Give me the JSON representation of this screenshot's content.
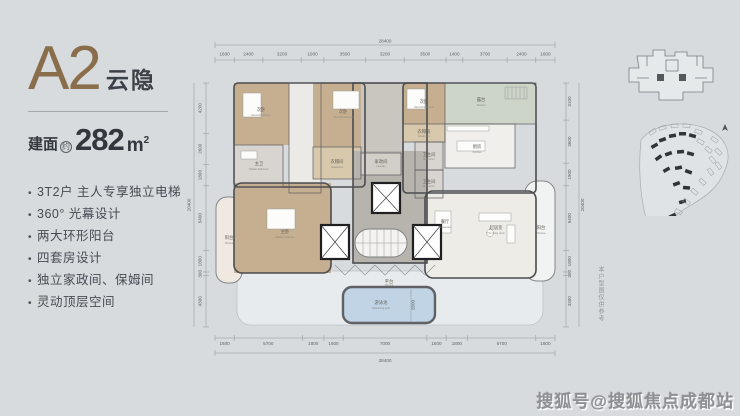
{
  "panel": {
    "unit_name": "A2",
    "unit_subname": "云隐",
    "area_prefix": "建面",
    "area_approx": "约",
    "area_value": "282",
    "area_unit": "m",
    "area_sup": "2",
    "features": [
      "3T2户 主人专享独立电梯",
      "360° 光幕设计",
      "两大环形阳台",
      "四套房设计",
      "独立家政间、保姆间",
      "灵动顶层空间"
    ]
  },
  "plan": {
    "dims": {
      "top_total": "28400",
      "top": [
        1600,
        2400,
        3200,
        1900,
        3500,
        3200,
        3500,
        1400,
        3700,
        2400,
        1600
      ],
      "bottom_total": "28400",
      "bottom": [
        1600,
        5700,
        1800,
        1600,
        7000,
        1600,
        1800,
        5700,
        1600
      ],
      "left_total": "20400",
      "left": [
        4200,
        2600,
        1800,
        5400,
        1800,
        300,
        4300
      ],
      "right_total": "20400",
      "right": [
        3100,
        3600,
        1900,
        5400,
        1800,
        300,
        4300
      ],
      "pool_width": "2600"
    },
    "rooms": [
      {
        "cn": "次卧",
        "en": "Second bedroom"
      },
      {
        "cn": "次卧",
        "en": "Second bedroom"
      },
      {
        "cn": "主卫",
        "en": "Master bathroom"
      },
      {
        "cn": "衣帽间",
        "en": "Cloakroom"
      },
      {
        "cn": "次卧",
        "en": "Second bedroom"
      },
      {
        "cn": "衣帽间",
        "en": "Cloakroom"
      },
      {
        "cn": "卫生间",
        "en": "Bathroom"
      },
      {
        "cn": "卫生间",
        "en": "Bathroom"
      },
      {
        "cn": "露台",
        "en": "Terrace"
      },
      {
        "cn": "厨房",
        "en": "Kitchen"
      },
      {
        "cn": "餐厅",
        "en": "Restaurant"
      },
      {
        "cn": "起居室",
        "en": "The living room"
      },
      {
        "cn": "阳台",
        "en": "Terrace"
      },
      {
        "cn": "主卧",
        "en": "Master bedroom"
      },
      {
        "cn": "阳台",
        "en": "Terrace"
      },
      {
        "cn": "家政间",
        "en": "Laundry"
      },
      {
        "cn": "平台",
        "en": "Terrace"
      },
      {
        "cn": "游泳池",
        "en": "Swimming pool"
      }
    ],
    "disclaimer": "本户型图仅供参考"
  },
  "watermark": {
    "text": "搜狐号@搜狐焦点成都站"
  },
  "colors": {
    "background": "#d7dbde",
    "accent_brown": "#8a6e4c",
    "text_dark": "#3d4248",
    "wood": "#c6af90",
    "wood_light": "#d8c9ad",
    "marble": "#edece7",
    "terrace_green": "#ccd5c8",
    "pool_blue": "#c0d4e6",
    "core_gray": "#b7b3ad"
  }
}
